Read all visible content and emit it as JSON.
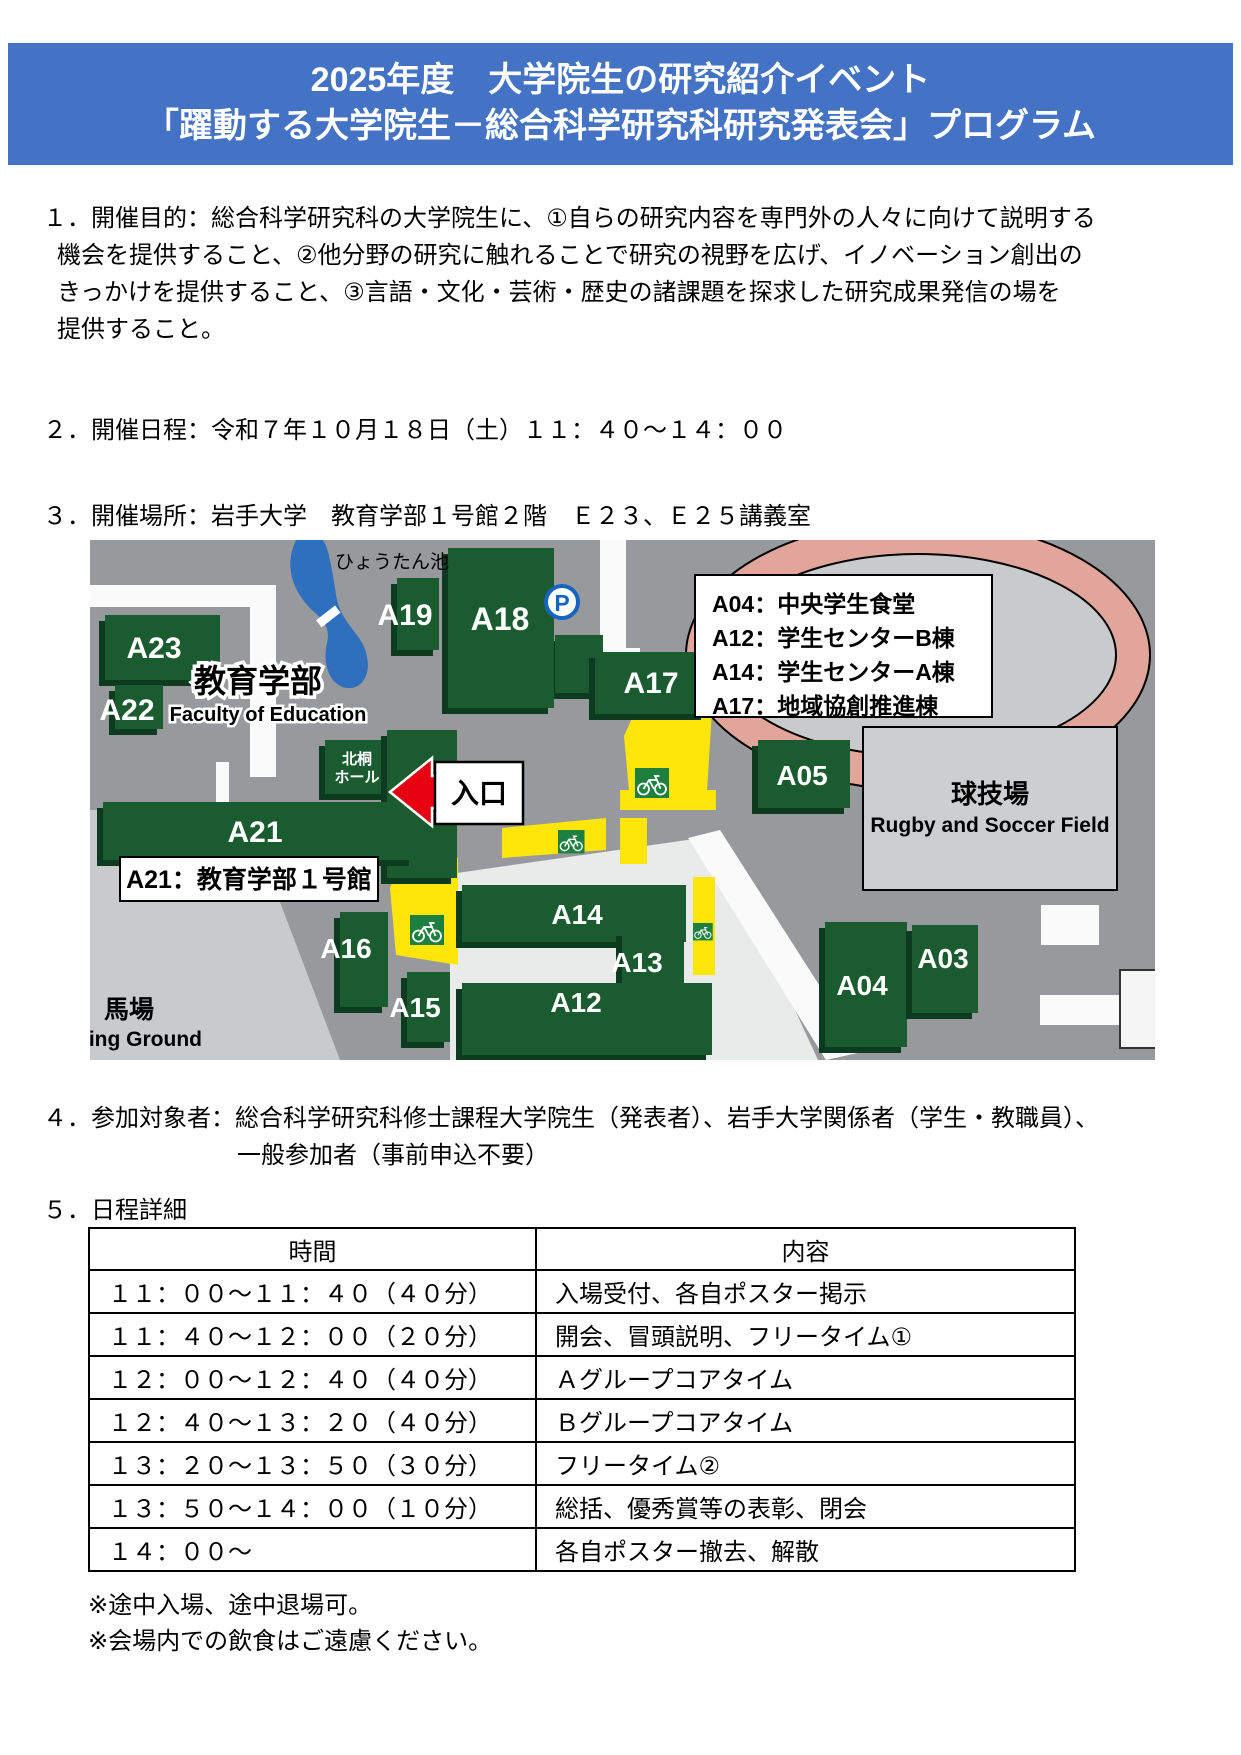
{
  "header": {
    "line1": "2025年度　大学院生の研究紹介イベント",
    "line2": "「躍動する大学院生－総合科学研究科研究発表会」プログラム",
    "bg_color": "#4472C4"
  },
  "sections": {
    "purpose": {
      "lines": [
        "１．開催目的：総合科学研究科の大学院生に、①自らの研究内容を専門外の人々に向けて説明する",
        "機会を提供すること、②他分野の研究に触れることで研究の視野を広げ、イノベーション創出の",
        "きっかけを提供すること、③言語・文化・芸術・歴史の諸課題を探求した研究成果発信の場を",
        "提供すること。"
      ]
    },
    "schedule": {
      "text": "２．開催日程：令和７年１０月１８日（土）１１：４０～１４：００"
    },
    "place": {
      "text": "３．開催場所：岩手大学　教育学部１号館２階　Ｅ２３、Ｅ２５講義室"
    },
    "participants": {
      "line1": "４．参加対象者：総合科学研究科修士課程大学院生（発表者）、岩手大学関係者（学生・教職員）、",
      "line2": "一般参加者（事前申込不要）"
    },
    "detail_heading": "５．日程詳細"
  },
  "map": {
    "pond_label": "ひょうたん池",
    "faculty_label_ja": "教育学部",
    "faculty_label_en": "Faculty of Education",
    "hokuto_line1": "北桐",
    "hokuto_line2": "ホール",
    "entrance_label": "入口",
    "parking_label": "P",
    "a21_note": "A21：教育学部１号館",
    "field_ja": "球技場",
    "field_en": "Rugby and Soccer Field",
    "baba_ja": "馬場",
    "baba_en": "ding Ground",
    "legend_lines": [
      "A04：中央学生食堂",
      "A12：学生センターB棟",
      "A14：学生センターA棟",
      "A17：地域協創推進棟"
    ],
    "building_labels": [
      "A23",
      "A22",
      "A19",
      "A18",
      "A17",
      "A21",
      "A16",
      "A15",
      "A14",
      "A13",
      "A12",
      "A05",
      "A04",
      "A03"
    ],
    "colors": {
      "building_green": "#1A5C30",
      "building_shadow": "#0D3B1F",
      "map_gray": "#97999C",
      "light_gray": "#C8CACC",
      "bike_yellow": "#FFE60A",
      "track_salmon": "#E2A59B",
      "pond_blue": "#2E6FBE",
      "arrow_red": "#E60012"
    }
  },
  "table": {
    "headers": [
      "時間",
      "内容"
    ],
    "rows": [
      [
        "１１：００～１１：４０（４０分）",
        "入場受付、各自ポスター掲示"
      ],
      [
        "１１：４０～１２：００（２０分）",
        "開会、冒頭説明、フリータイム①"
      ],
      [
        "１２：００～１２：４０（４０分）",
        "Ａグループコアタイム"
      ],
      [
        "１２：４０～１３：２０（４０分）",
        "Ｂグループコアタイム"
      ],
      [
        "１３：２０～１３：５０（３０分）",
        "フリータイム②"
      ],
      [
        "１３：５０～１４：００（１０分）",
        "総括、優秀賞等の表彰、閉会"
      ],
      [
        "１４：００～",
        "各自ポスター撤去、解散"
      ]
    ]
  },
  "notes": [
    "※途中入場、途中退場可。",
    "※会場内での飲食はご遠慮ください。"
  ]
}
